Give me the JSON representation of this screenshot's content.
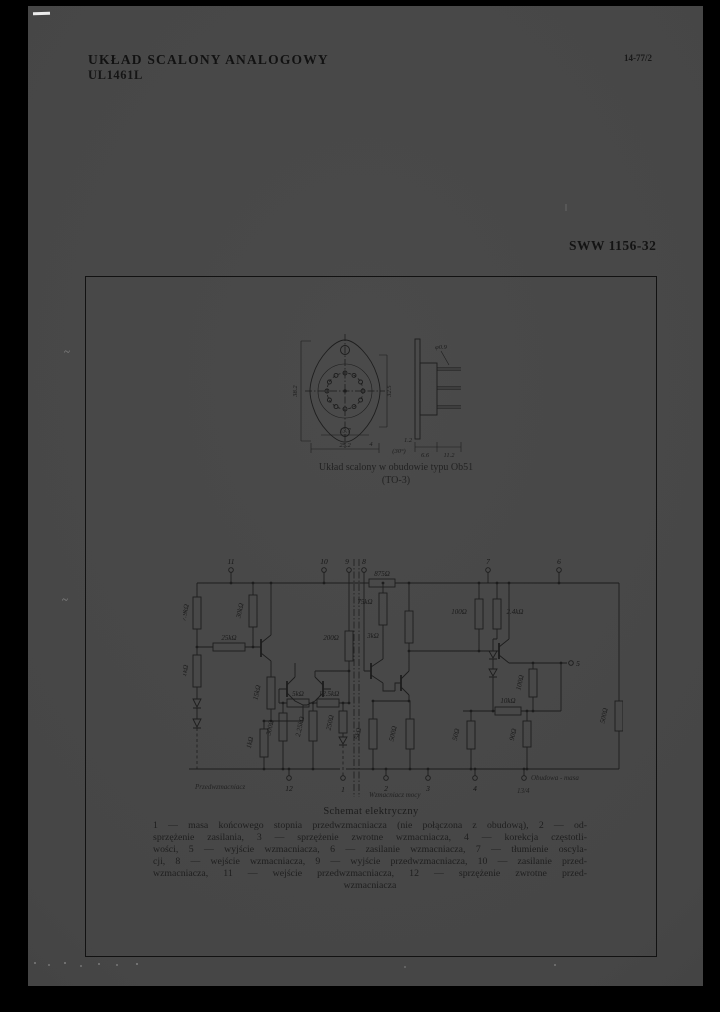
{
  "header": {
    "title": "UKŁAD SCALONY ANALOGOWY",
    "part_number": "UL1461L",
    "doc_code": "14-77/2",
    "sww_code": "SWW 1156-32"
  },
  "package": {
    "caption_line1": "Układ scalony w obudowie typu Ob51",
    "caption_line2": "(TO-3)",
    "dims": [
      "38.2",
      "32.5",
      "13.7",
      "25.2",
      "(30°)",
      "φ0.9",
      "1.2",
      "6.6",
      "11.2",
      "4"
    ]
  },
  "schematic": {
    "pins": {
      "top": [
        "11",
        "10",
        "9",
        "8",
        "7",
        "6"
      ],
      "bottom": [
        "12",
        "1",
        "2",
        "3",
        "4"
      ],
      "output": "5"
    },
    "values": [
      "7.9kΩ",
      "1kΩ",
      "25kΩ",
      "30kΩ",
      "15kΩ",
      "1kΩ",
      "5kΩ",
      "12.5kΩ",
      "2.25kΩ",
      "300Ω",
      "250Ω",
      "75kΩ",
      "200Ω",
      "875Ω",
      "3kΩ",
      "5kΩ",
      "500Ω",
      "100Ω",
      "2.4kΩ",
      "100Ω",
      "10kΩ",
      "50Ω",
      "90Ω",
      "500Ω"
    ],
    "area_labels": {
      "left": "Przedwzmacniacz",
      "right": "Wzmacniacz mocy"
    },
    "case_label": "Obudowa - masa",
    "case_sub": "13/4"
  },
  "schematic_caption": {
    "title": "Schemat elektryczny",
    "lines": [
      "1 — masa końcowego stopnia przedwzmacniacza (nie połączona z obudową), 2 — od-",
      "sprzężenie zasilania, 3 — sprzężenie zwrotne wzmacniacza, 4 — korekcja częstotli-",
      "wości, 5 — wyjście wzmacniacza, 6 — zasilanie wzmacniacza, 7 — tłumienie oscyla-",
      "cji, 8 — wejście wzmacniacza, 9 — wyjście przedwzmacniacza, 10 — zasilanie przed-",
      "wzmacniacza, 11 — wejście przedwzmacniacza, 12 — sprzężenie zwrotne przed-",
      "wzmacniacza"
    ]
  },
  "artifacts": {
    "tilde": "~"
  }
}
